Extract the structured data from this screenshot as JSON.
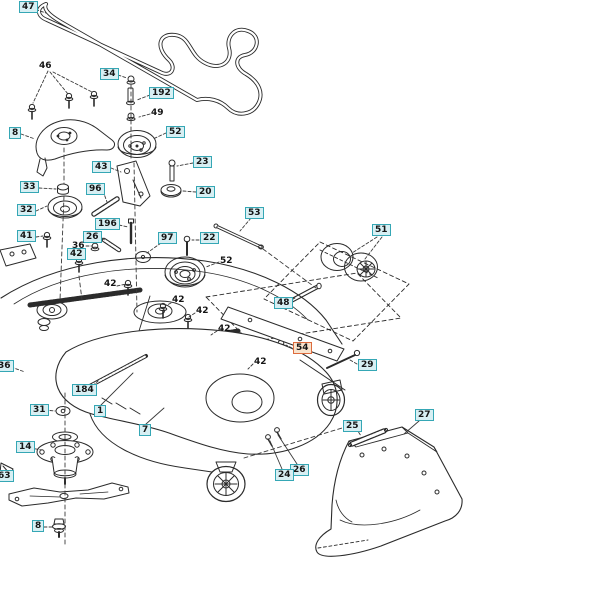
{
  "canvas": {
    "width": 603,
    "height": 611,
    "background": "#ffffff"
  },
  "diagram": {
    "kind": "exploded-parts-diagram",
    "subject": "mower-deck-assembly",
    "colors": {
      "label_border": "#35a7b5",
      "label_bg": "#d7eff3",
      "highlight_border": "#dd6b3d",
      "highlight_bg": "#f8e3cd",
      "line": "#2b2b2b",
      "text": "#151515"
    },
    "highlighted_part": {
      "number": "54"
    },
    "labels": [
      {
        "text": "47",
        "x": 19,
        "y": 1,
        "style": "boxed"
      },
      {
        "text": "46",
        "x": 39,
        "y": 61,
        "style": "plain"
      },
      {
        "text": "34",
        "x": 100,
        "y": 68,
        "style": "boxed"
      },
      {
        "text": "192",
        "x": 149,
        "y": 87,
        "style": "boxed"
      },
      {
        "text": "49",
        "x": 151,
        "y": 108,
        "style": "plain"
      },
      {
        "text": "8",
        "x": 9,
        "y": 127,
        "style": "boxed"
      },
      {
        "text": "52",
        "x": 166,
        "y": 126,
        "style": "boxed"
      },
      {
        "text": "43",
        "x": 92,
        "y": 161,
        "style": "boxed"
      },
      {
        "text": "23",
        "x": 193,
        "y": 156,
        "style": "boxed"
      },
      {
        "text": "33",
        "x": 20,
        "y": 181,
        "style": "boxed"
      },
      {
        "text": "96",
        "x": 86,
        "y": 183,
        "style": "boxed"
      },
      {
        "text": "20",
        "x": 196,
        "y": 186,
        "style": "boxed"
      },
      {
        "text": "32",
        "x": 17,
        "y": 204,
        "style": "boxed"
      },
      {
        "text": "53",
        "x": 245,
        "y": 207,
        "style": "boxed"
      },
      {
        "text": "196",
        "x": 95,
        "y": 218,
        "style": "boxed"
      },
      {
        "text": "41",
        "x": 17,
        "y": 230,
        "style": "boxed"
      },
      {
        "text": "26",
        "x": 83,
        "y": 231,
        "style": "boxed"
      },
      {
        "text": "97",
        "x": 158,
        "y": 232,
        "style": "boxed"
      },
      {
        "text": "22",
        "x": 200,
        "y": 232,
        "style": "boxed"
      },
      {
        "text": "36",
        "x": 72,
        "y": 241,
        "style": "plain"
      },
      {
        "text": "42",
        "x": 67,
        "y": 248,
        "style": "boxed"
      },
      {
        "text": "51",
        "x": 372,
        "y": 224,
        "style": "boxed"
      },
      {
        "text": "52",
        "x": 220,
        "y": 256,
        "style": "plain"
      },
      {
        "text": "42",
        "x": 104,
        "y": 279,
        "style": "plain"
      },
      {
        "text": "42",
        "x": 172,
        "y": 295,
        "style": "plain"
      },
      {
        "text": "48",
        "x": 274,
        "y": 297,
        "style": "boxed"
      },
      {
        "text": "42",
        "x": 196,
        "y": 306,
        "style": "plain"
      },
      {
        "text": "42",
        "x": 218,
        "y": 324,
        "style": "plain"
      },
      {
        "text": "54",
        "x": 293,
        "y": 342,
        "style": "highlighted"
      },
      {
        "text": "42",
        "x": 254,
        "y": 357,
        "style": "plain"
      },
      {
        "text": "36",
        "x": -5,
        "y": 360,
        "style": "boxed"
      },
      {
        "text": "29",
        "x": 358,
        "y": 359,
        "style": "boxed"
      },
      {
        "text": "184",
        "x": 72,
        "y": 384,
        "style": "boxed"
      },
      {
        "text": "31",
        "x": 30,
        "y": 404,
        "style": "boxed"
      },
      {
        "text": "1",
        "x": 94,
        "y": 405,
        "style": "boxed"
      },
      {
        "text": "27",
        "x": 415,
        "y": 409,
        "style": "boxed"
      },
      {
        "text": "25",
        "x": 343,
        "y": 420,
        "style": "boxed"
      },
      {
        "text": "7",
        "x": 139,
        "y": 424,
        "style": "boxed"
      },
      {
        "text": "14",
        "x": 16,
        "y": 441,
        "style": "boxed"
      },
      {
        "text": "26",
        "x": 290,
        "y": 464,
        "style": "boxed"
      },
      {
        "text": "24",
        "x": 275,
        "y": 469,
        "style": "boxed"
      },
      {
        "text": "63",
        "x": -5,
        "y": 470,
        "style": "boxed"
      },
      {
        "text": "8",
        "x": 32,
        "y": 520,
        "style": "boxed"
      }
    ]
  }
}
